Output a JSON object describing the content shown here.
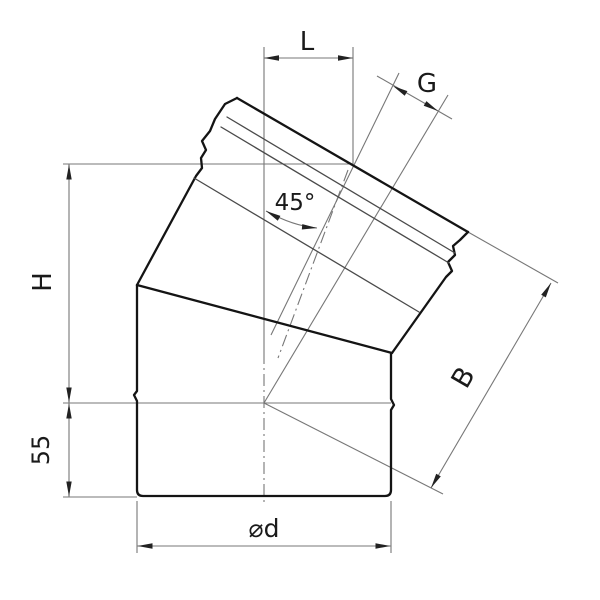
{
  "drawing": {
    "type": "technical drawing of a 45-degree pipe elbow, front view",
    "labels": {
      "offset": "L",
      "spigot": "G",
      "angle": "45°",
      "height": "H",
      "side": "B",
      "insertion": "55",
      "diameter": "⌀d"
    },
    "colors": {
      "background": "#ffffff",
      "outline": "#141414",
      "dimension_lines": "#777777",
      "text": "#1a1a1a"
    }
  }
}
